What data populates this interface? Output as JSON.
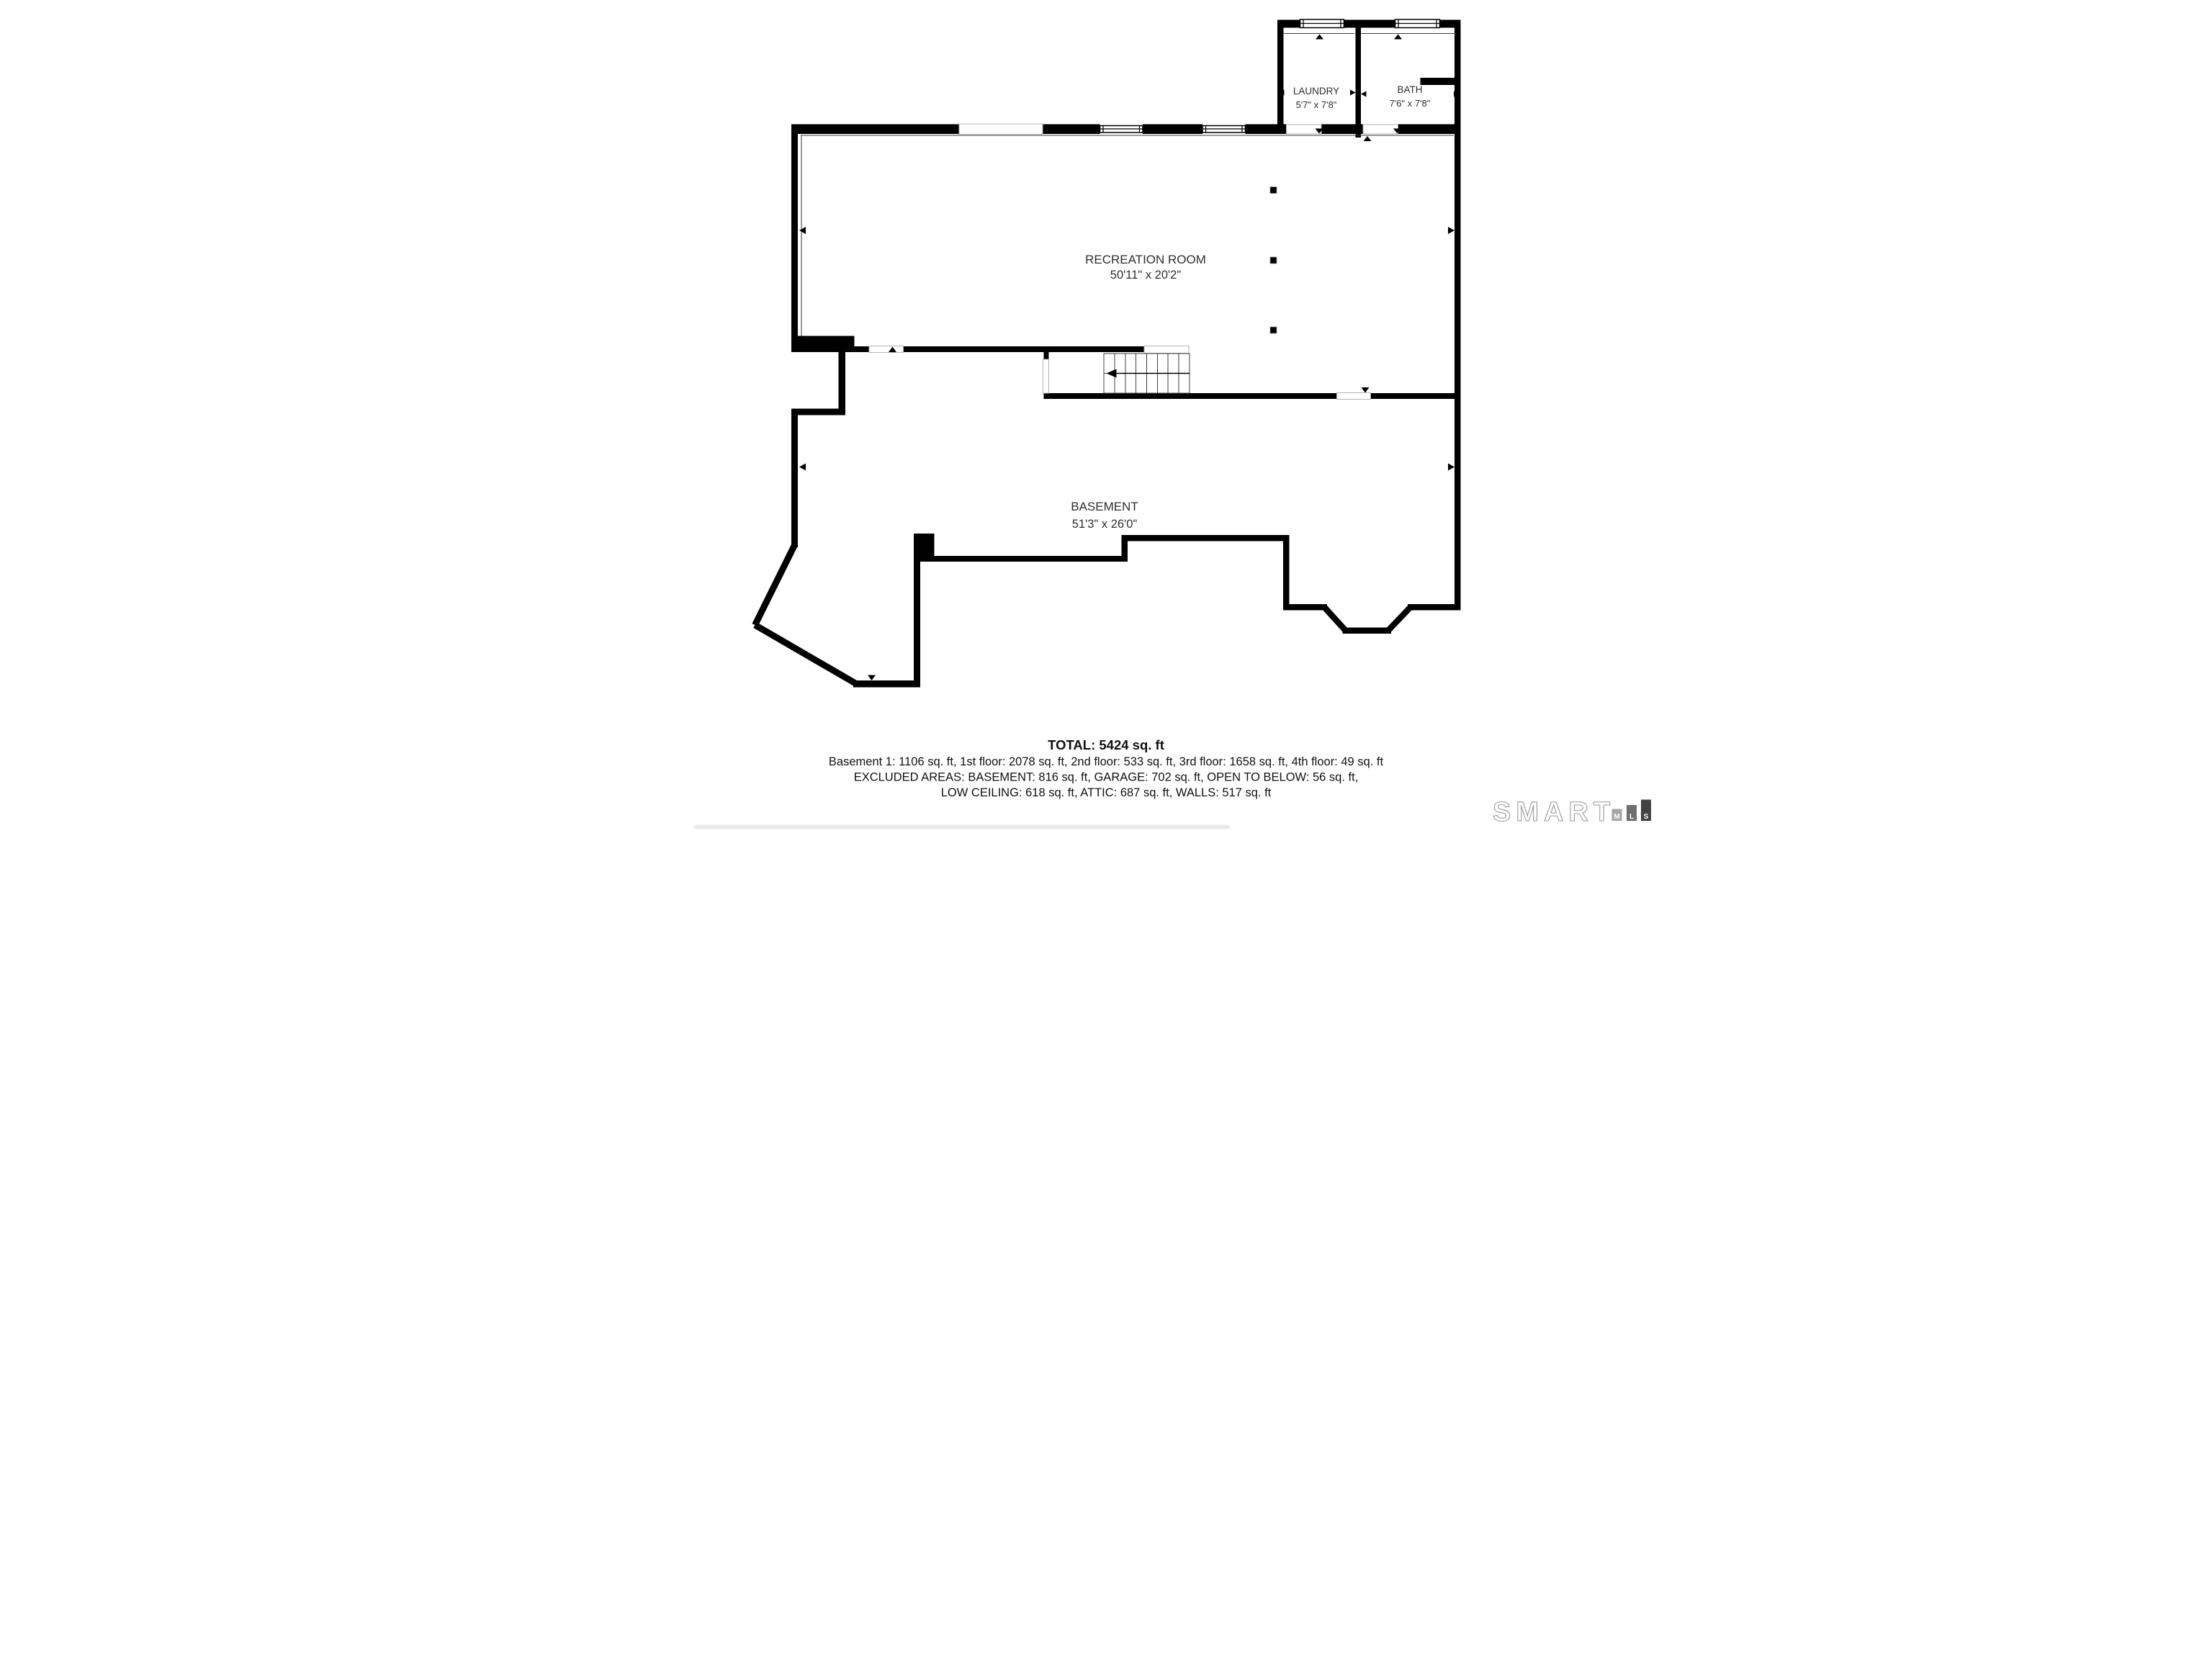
{
  "rooms": {
    "laundry": {
      "name": "LAUNDRY",
      "dims": "5'7\" x 7'8\""
    },
    "bath": {
      "name": "BATH",
      "dims": "7'6\" x 7'8\""
    },
    "recreation": {
      "name": "RECREATION ROOM",
      "dims": "50'11\" x 20'2\""
    },
    "basement": {
      "name": "BASEMENT",
      "dims": "51'3\" x 26'0\""
    }
  },
  "summary": {
    "total": "TOTAL: 5424 sq. ft",
    "floors": "Basement 1: 1106 sq. ft, 1st floor: 2078 sq. ft, 2nd floor: 533 sq. ft, 3rd floor: 1658 sq. ft, 4th floor: 49 sq. ft",
    "excluded1": "EXCLUDED AREAS: BASEMENT: 816 sq. ft, GARAGE: 702 sq. ft, OPEN TO BELOW: 56 sq. ft,",
    "excluded2": "LOW CEILING: 618 sq. ft, ATTIC: 687 sq. ft, WALLS: 517 sq. ft"
  },
  "logo": {
    "brand": "SMART",
    "mls": {
      "m": "M",
      "l": "L",
      "s": "S"
    }
  },
  "colors": {
    "wall": "#000000",
    "label": "#2e2e2e",
    "logo_outline": "#9a9a9a",
    "logo_m": "#a6a6a6",
    "logo_l": "#6f6f6f",
    "logo_s": "#424242"
  }
}
